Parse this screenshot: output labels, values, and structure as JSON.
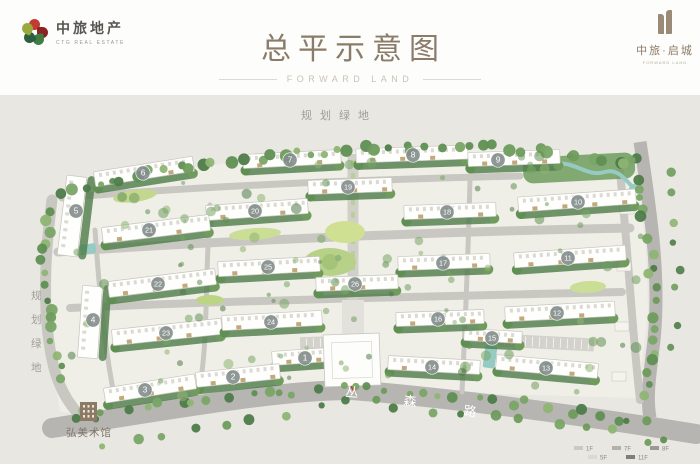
{
  "header": {
    "brand_left": {
      "name_cn": "中旅地产",
      "name_en": "CTG REAL ESTATE"
    },
    "title": "总平示意图",
    "subtitle": "FORWARD LAND",
    "brand_right": {
      "name_cn": "中旅·启城",
      "name_en": "FORWARD LAND"
    }
  },
  "plan": {
    "labels": {
      "top_green": "规划绿地",
      "left_green": "规划绿地",
      "museum": "弘美术馆",
      "road_name": "丛森路"
    },
    "colors": {
      "mapBg": "#e9e7e2",
      "parcel": "#f0efe7",
      "roadOuter": "#b6b5b1",
      "roadInner": "#c8c7c2",
      "axis": "#d0cfca",
      "treeDark": "#4e7c49",
      "water": "#96cbc4",
      "accentRed": "#c0392b",
      "circleFill": "#838e8c",
      "labelGray": "#a09e98",
      "roadText": "#ffffff",
      "building": "#fefefc",
      "buildingStroke": "#c6c4be",
      "canopyTan": "#c3a87e"
    },
    "units": [
      {
        "n": 1,
        "cx": 305,
        "cy": 358,
        "slab": [
          272,
          349,
          72,
          14,
          -4
        ]
      },
      {
        "n": 2,
        "cx": 233,
        "cy": 377,
        "slab": [
          196,
          368,
          84,
          15,
          -6
        ]
      },
      {
        "n": 3,
        "cx": 145,
        "cy": 390,
        "slab": [
          104,
          381,
          92,
          15,
          -9
        ]
      },
      {
        "n": 4,
        "cx": 93,
        "cy": 320,
        "slab": [
          80,
          286,
          20,
          72,
          4
        ]
      },
      {
        "n": 5,
        "cx": 76,
        "cy": 211,
        "slab": [
          62,
          176,
          20,
          80,
          7
        ]
      },
      {
        "n": 6,
        "cx": 143,
        "cy": 173,
        "slab": [
          94,
          164,
          100,
          15,
          -9
        ]
      },
      {
        "n": 7,
        "cx": 290,
        "cy": 160,
        "slab": [
          243,
          152,
          98,
          14,
          -3
        ]
      },
      {
        "n": 8,
        "cx": 413,
        "cy": 155,
        "slab": [
          356,
          147,
          112,
          14,
          -2
        ]
      },
      {
        "n": 9,
        "cx": 498,
        "cy": 160,
        "slab": [
          468,
          151,
          92,
          14,
          -2
        ]
      },
      {
        "n": 10,
        "cx": 578,
        "cy": 202,
        "slab": [
          518,
          193,
          118,
          15,
          -4
        ]
      },
      {
        "n": 11,
        "cx": 568,
        "cy": 258,
        "slab": [
          514,
          249,
          112,
          15,
          -4
        ]
      },
      {
        "n": 12,
        "cx": 557,
        "cy": 313,
        "slab": [
          505,
          304,
          110,
          15,
          -3
        ]
      },
      {
        "n": 13,
        "cx": 546,
        "cy": 368,
        "slab": [
          496,
          359,
          102,
          15,
          5
        ]
      },
      {
        "n": 14,
        "cx": 432,
        "cy": 367,
        "slab": [
          388,
          358,
          92,
          14,
          3
        ]
      },
      {
        "n": 15,
        "cx": 492,
        "cy": 338,
        "slab": [
          464,
          330,
          58,
          12,
          3
        ]
      },
      {
        "n": 16,
        "cx": 438,
        "cy": 319,
        "slab": [
          396,
          311,
          88,
          14,
          -2
        ]
      },
      {
        "n": 17,
        "cx": 443,
        "cy": 263,
        "slab": [
          398,
          255,
          92,
          14,
          -2
        ]
      },
      {
        "n": 18,
        "cx": 447,
        "cy": 212,
        "slab": [
          404,
          204,
          92,
          14,
          -2
        ]
      },
      {
        "n": 19,
        "cx": 348,
        "cy": 187,
        "slab": [
          308,
          179,
          84,
          14,
          -2
        ]
      },
      {
        "n": 20,
        "cx": 255,
        "cy": 211,
        "slab": [
          206,
          202,
          102,
          15,
          -4
        ]
      },
      {
        "n": 21,
        "cx": 149,
        "cy": 230,
        "slab": [
          102,
          221,
          108,
          16,
          -7
        ]
      },
      {
        "n": 22,
        "cx": 158,
        "cy": 284,
        "slab": [
          108,
          275,
          108,
          16,
          -7
        ]
      },
      {
        "n": 23,
        "cx": 166,
        "cy": 333,
        "slab": [
          112,
          324,
          110,
          16,
          -6
        ]
      },
      {
        "n": 24,
        "cx": 271,
        "cy": 322,
        "slab": [
          222,
          313,
          100,
          15,
          -3
        ]
      },
      {
        "n": 25,
        "cx": 268,
        "cy": 267,
        "slab": [
          218,
          259,
          102,
          15,
          -3
        ]
      },
      {
        "n": 26,
        "cx": 355,
        "cy": 284,
        "slab": [
          316,
          276,
          82,
          14,
          -2
        ]
      }
    ],
    "legend": {
      "rows": [
        [
          {
            "color": "#cbc9c4",
            "label": "1F"
          },
          {
            "color": "#b3b1ac",
            "label": "7F"
          },
          {
            "color": "#9b9994",
            "label": "8F"
          }
        ],
        [
          {
            "color": "#dbd9d4",
            "label": "5F"
          },
          {
            "color": "#807e79",
            "label": "11F"
          }
        ]
      ]
    }
  }
}
